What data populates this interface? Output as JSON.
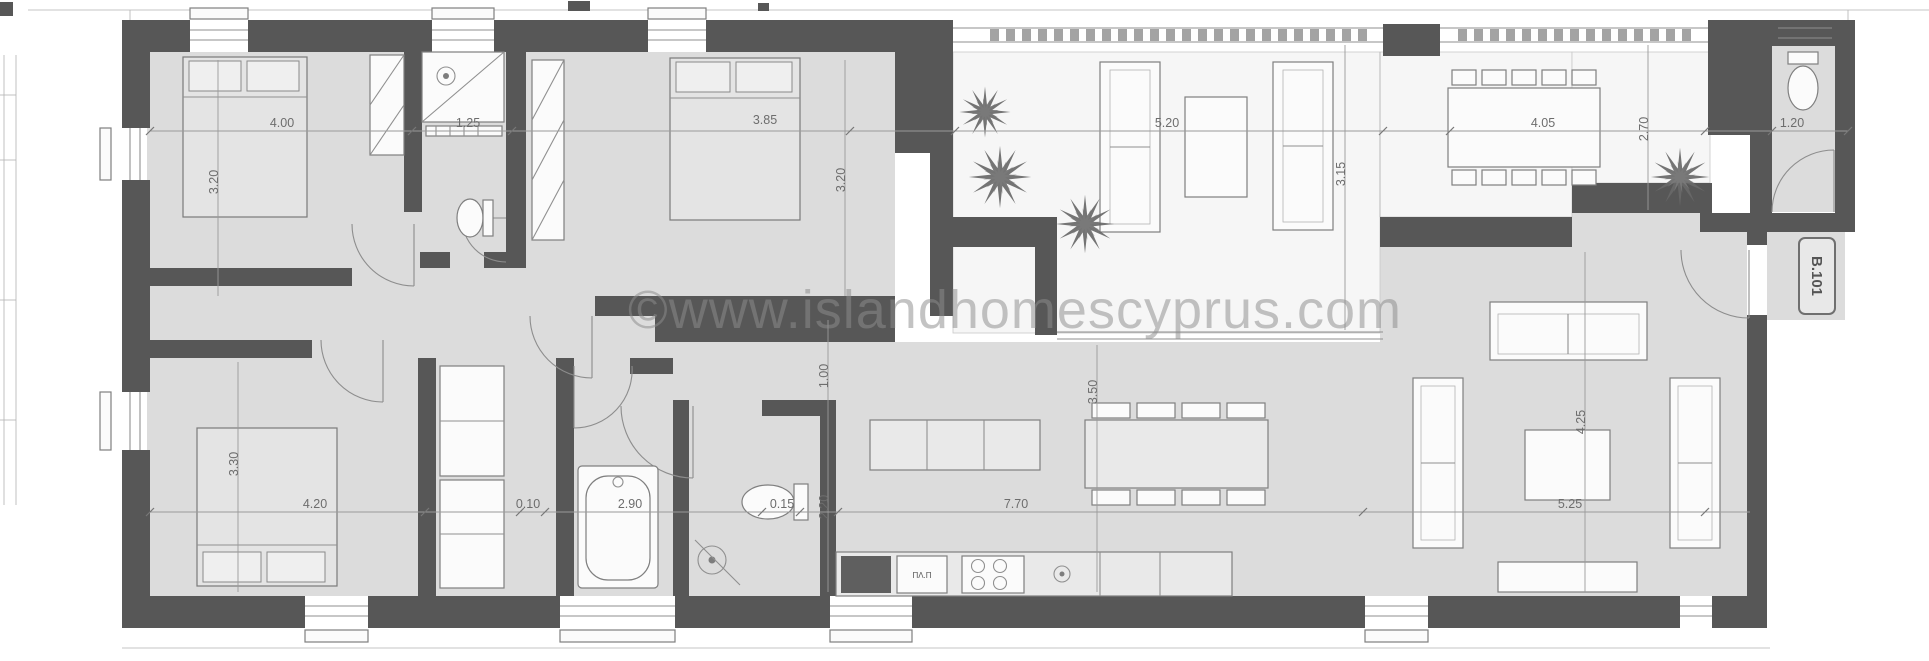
{
  "watermark": {
    "text": "©www.islandhomescyprus.com"
  },
  "badge": {
    "label": "B.101"
  },
  "labels": {
    "appliance": "ΠΛ.Π"
  },
  "dimensions": {
    "top": [
      {
        "value": "4.00"
      },
      {
        "value": "1.25"
      },
      {
        "value": "3.85"
      },
      {
        "value": "5.20"
      },
      {
        "value": "4.05"
      },
      {
        "value": "1.20"
      }
    ],
    "middle": [
      {
        "value": "4.20"
      },
      {
        "value": "0.10"
      },
      {
        "value": "2.90"
      },
      {
        "value": "0.15"
      },
      {
        "value": "7.70"
      },
      {
        "value": "5.25"
      }
    ],
    "vertical": [
      {
        "value": "3.20"
      },
      {
        "value": "3.30"
      },
      {
        "value": "3.20"
      },
      {
        "value": "1.00"
      },
      {
        "value": "2.20"
      },
      {
        "value": "3.50"
      },
      {
        "value": "3.15"
      },
      {
        "value": "2.70"
      },
      {
        "value": "4.25"
      }
    ]
  },
  "colors": {
    "wall": "#575757",
    "floor": "#dcdcdc",
    "terrace": "#f6f6f6",
    "dim_text": "#6d6d6d",
    "watermark": "#8d8d8d"
  }
}
